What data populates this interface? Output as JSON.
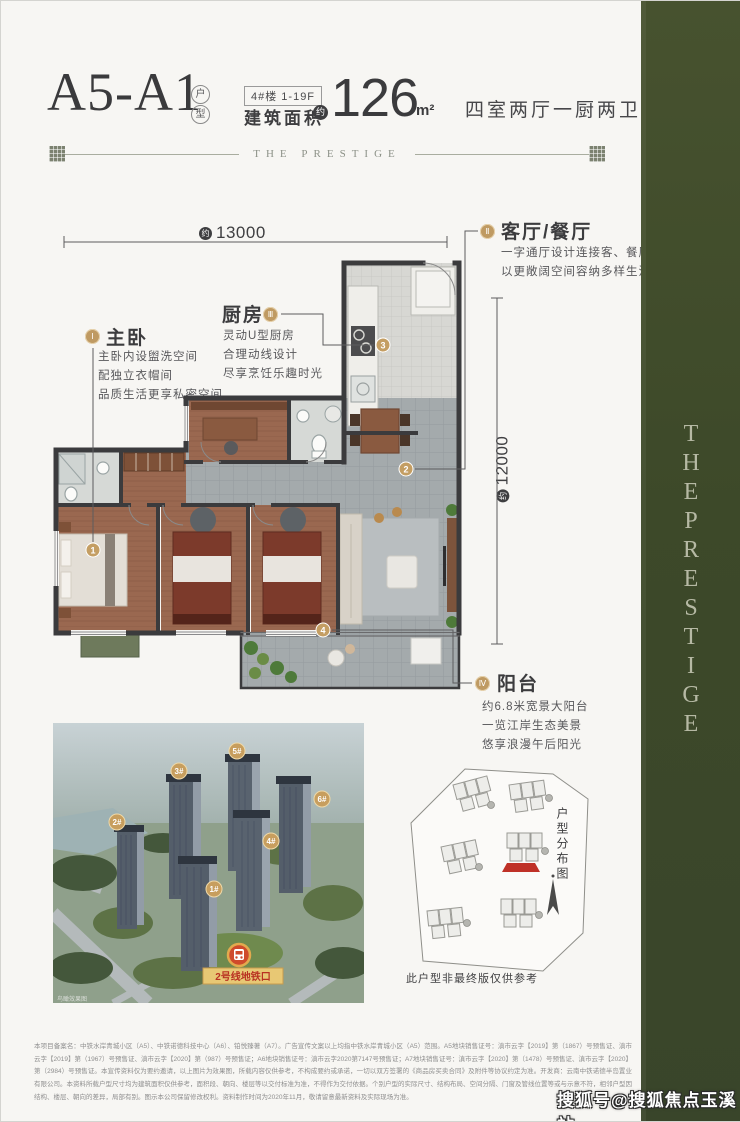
{
  "header": {
    "unit_code": "A5-A1",
    "unit_type_chars": [
      "户",
      "型"
    ],
    "building_tag": "4#楼 1-19F",
    "area_label": "建筑面积",
    "approx_char": "约",
    "area_value": "126",
    "area_unit": "m²",
    "layout_desc": "四室两厅一厨两卫",
    "brand_divider": "THE PRESTIGE"
  },
  "dimensions": {
    "approx_char": "约",
    "width": "13000",
    "depth": "12000"
  },
  "callouts": [
    {
      "numeral": "Ⅰ",
      "title": "主卧",
      "lines": [
        "主卧内设盥洗空间",
        "配独立衣帽间",
        "品质生活更享私密空间"
      ]
    },
    {
      "numeral": "Ⅱ",
      "title": "客厅/餐厅",
      "lines": [
        "一字通厅设计连接客、餐厅",
        "以更敞阔空间容纳多样生活"
      ]
    },
    {
      "numeral": "Ⅲ",
      "title": "厨房",
      "lines": [
        "灵动U型厨房",
        "合理动线设计",
        "尽享烹饪乐趣时光"
      ]
    },
    {
      "numeral": "Ⅳ",
      "title": "阳台",
      "lines": [
        "约6.8米宽景大阳台",
        "一览江岸生态美景",
        "悠享浪漫午后阳光"
      ]
    }
  ],
  "plan_markers": [
    "1",
    "2",
    "3",
    "4"
  ],
  "aerial": {
    "tower_badges": [
      "1#",
      "2#",
      "3#",
      "4#",
      "5#",
      "6#"
    ],
    "metro_banner": "2号线地铁口",
    "caption": "鸟瞰效果图"
  },
  "siteplan": {
    "title": "户型分布图",
    "note": "此户型非最终版仅供参考"
  },
  "band": {
    "vertical_text": "THEPRESTIGE"
  },
  "watermark": "搜狐号@搜狐焦点玉溪站",
  "disclaimer": "本项目备案名：中铁水岸青城小区（A5）、中铁诺德科技中心（A6）、铂悦臻著（A7）。广告宣传文案以上均指中铁水岸青城小区（A5）范围。A5地块销售证号：滇市云字【2019】第（1867）号预售证、滇市云字【2019】第（1967）号预售证、滇市云字【2020】第（987）号预售证；A6地块销售证号：滇市云字2020第7147号预售证；A7地块销售证号：滇市云字【2020】第（1478）号预售证、滇市云字【2020】第（2984）号预售证。本宣传资料仅为要约邀请，以上图片为效果图，所载内容仅供参考，不构成要约或承诺，一切以双方签署的《商品房买卖合同》及附件等协议约定为准。开发商：云南中铁诺德半岛置业有限公司。本资料所载户型尺寸均为建筑面积仅供参考，面积段、朝向、楼层等以交付标准为准，不得作为交付依据。个别户型的实际尺寸、结构布局、空间分隔、门窗及管线位置等或与示意不符，相邻户型因结构、楼层、朝向的差异，局部有别。图示本公司保留修改权利。资料制作时间为2020年11月，敬请留意最新资料及实际现场为准。",
  "colors": {
    "accent_gold": "#bf9a62",
    "band_green": "#3f4a2e",
    "wall": "#3b3b3d",
    "highlight_red": "#bf3127"
  }
}
